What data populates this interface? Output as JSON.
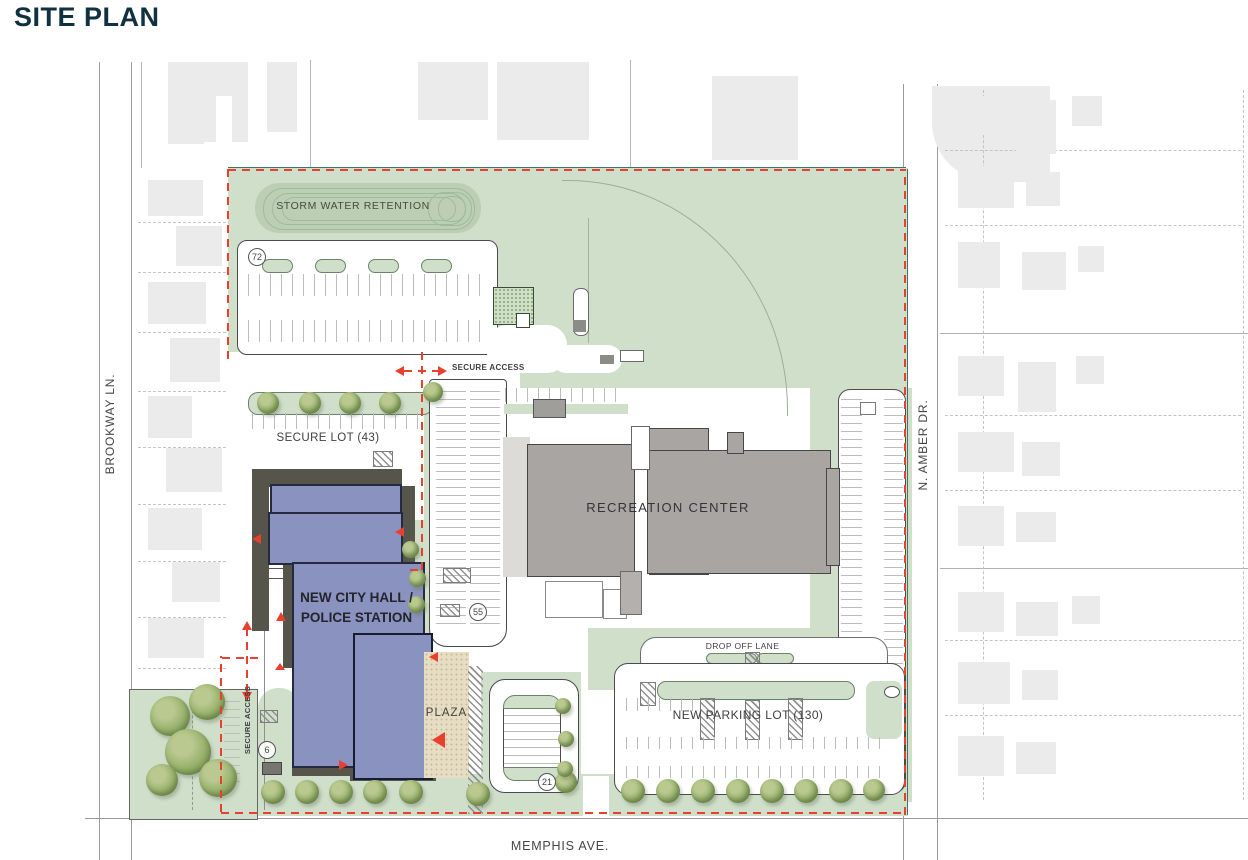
{
  "title": "SITE PLAN",
  "streets": {
    "left": "BROOKWAY LN.",
    "right": "N. AMBER DR.",
    "bottom": "MEMPHIS AVE."
  },
  "site": {
    "storm_water_label": "STORM WATER RETENTION",
    "secure_lot_label": "SECURE LOT (43)",
    "recreation_center_label": "RECREATION CENTER",
    "city_hall_line1": "NEW CITY HALL /",
    "city_hall_line2": "POLICE STATION",
    "plaza_label": "PLAZA",
    "drop_off_label": "DROP OFF LANE",
    "new_parking_label": "NEW PARKING LOT (130)",
    "secure_access_north_label": "SECURE ACCESS",
    "secure_access_west_label": "SECURE ACCESS"
  },
  "counts": {
    "north_lot": "72",
    "center_lot": "55",
    "west_drive": "6",
    "plaza_lot": "21"
  },
  "colors": {
    "title": "#0F3140",
    "site_green": "#CFDFCA",
    "retention_green": "#BCCFB5",
    "building_blue": "#8A92BF",
    "building_gray": "#A8A5A3",
    "shadow": "#56554B",
    "plaza_tan": "#E7DDC5",
    "boundary_red": "#E8402F",
    "property_teal": "#3F7268",
    "tree_green": "#93AD67",
    "context_gray": "#EBEBEB"
  }
}
